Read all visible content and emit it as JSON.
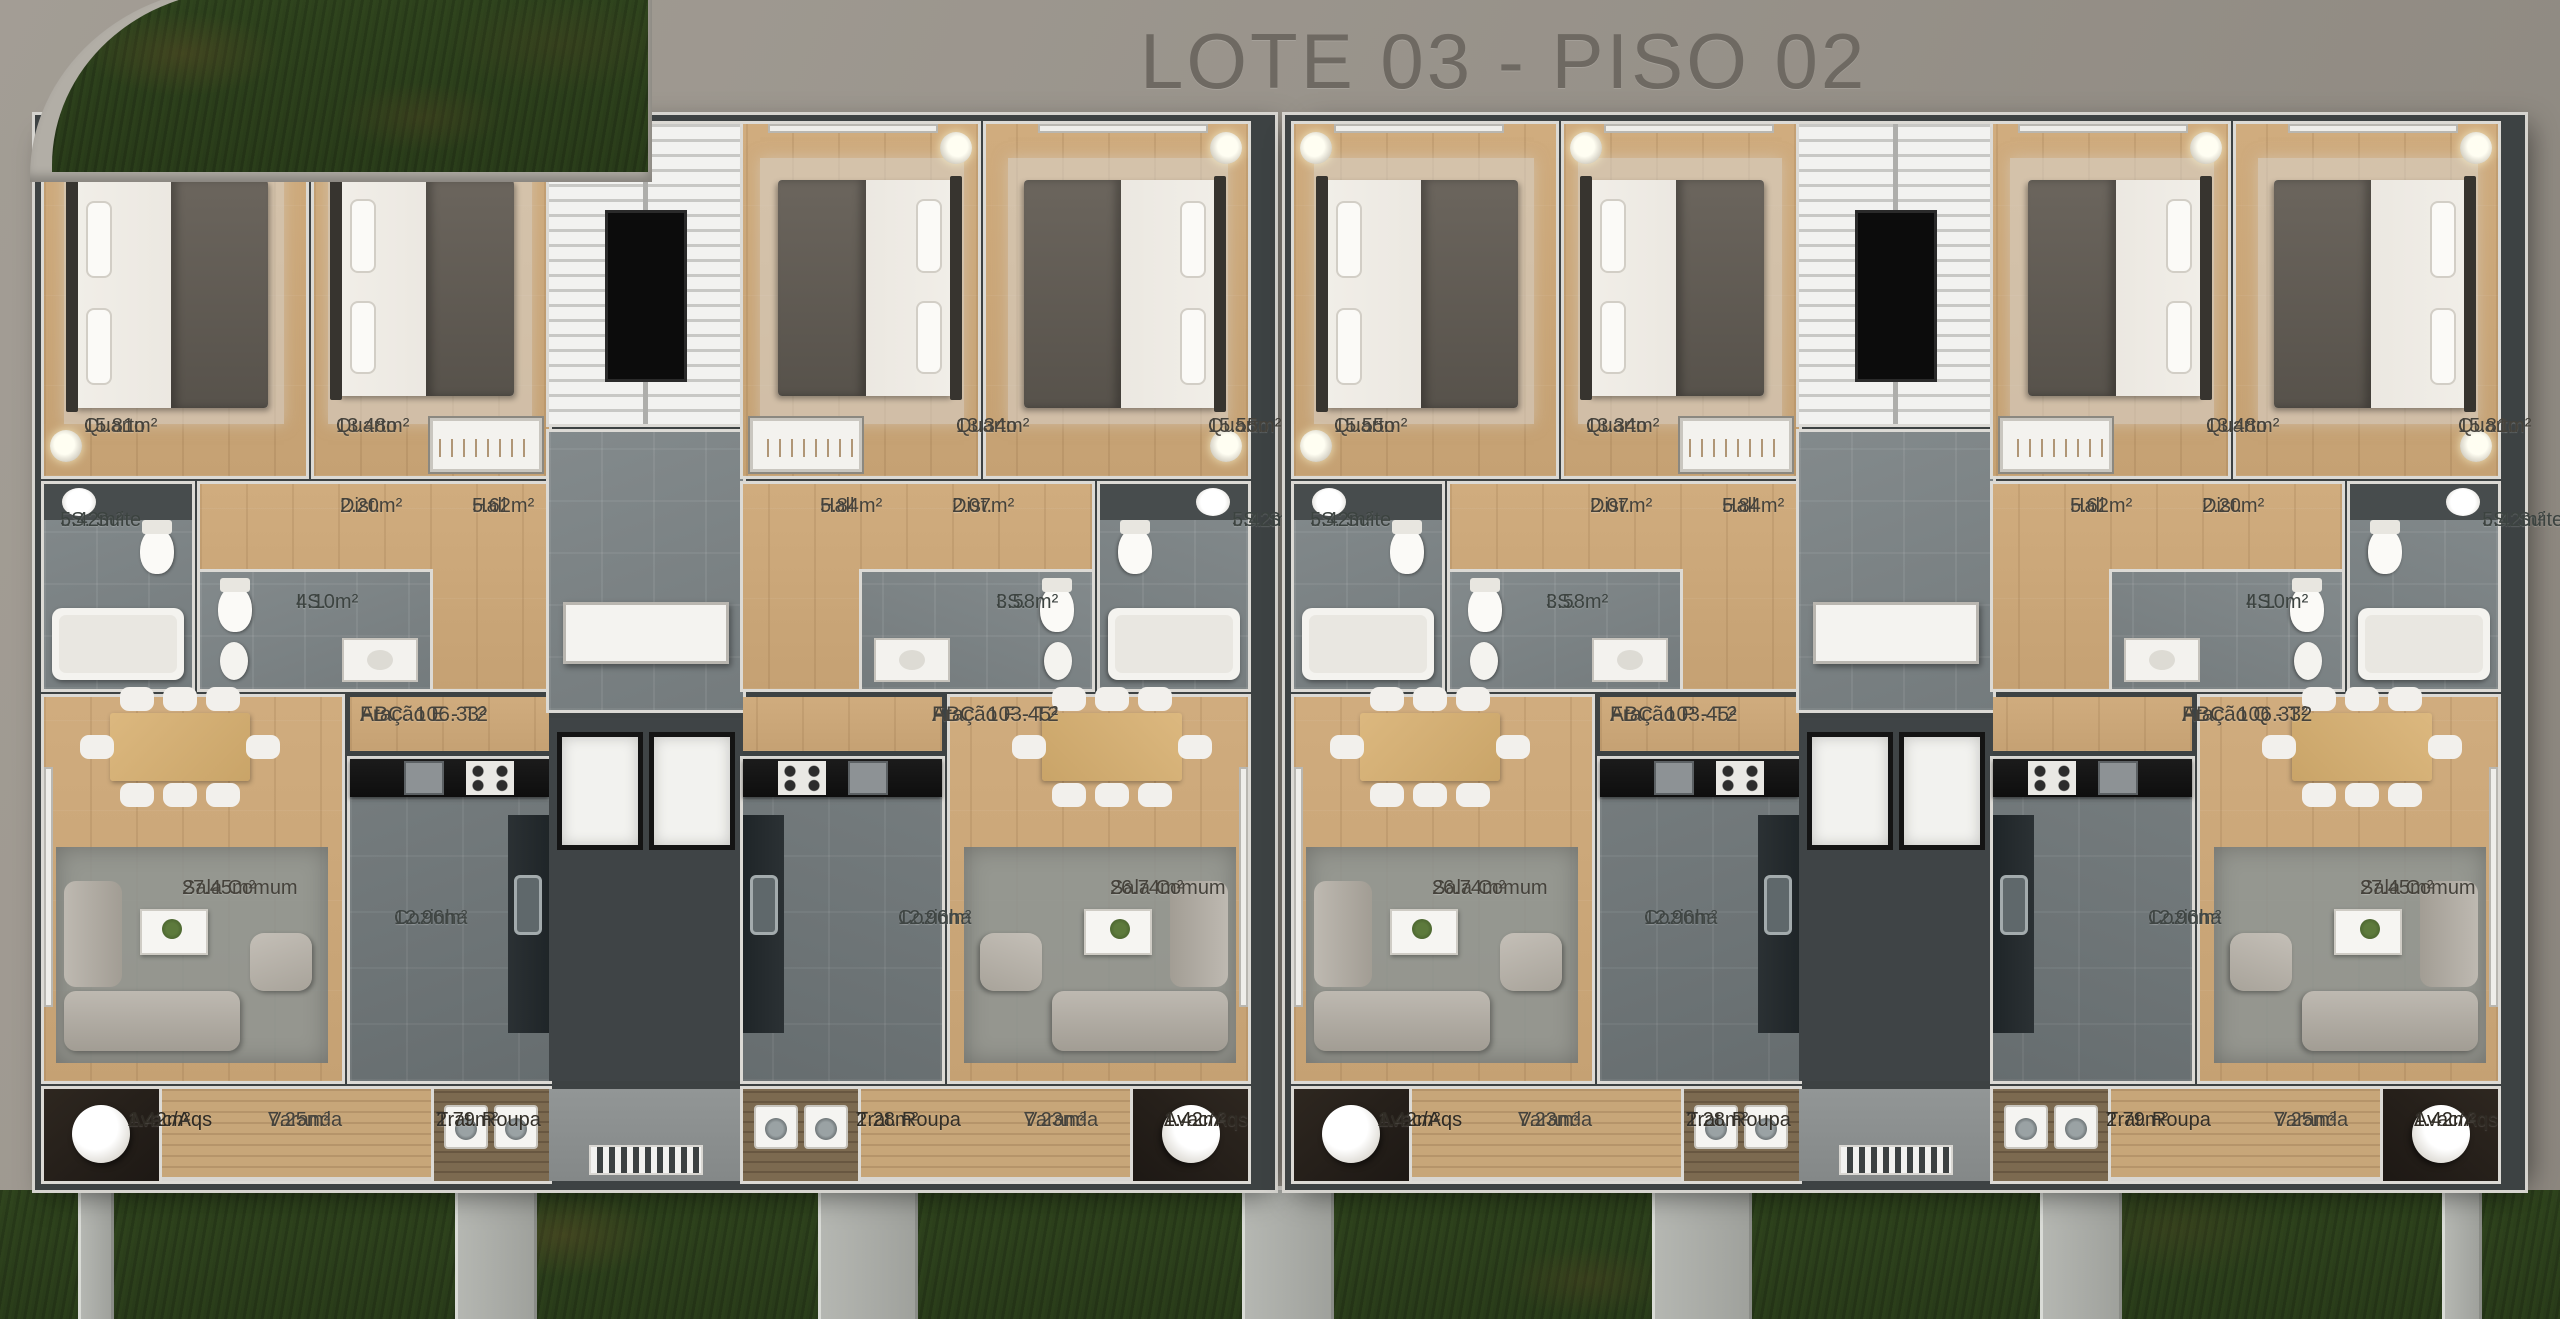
{
  "title": "LOTE 03 - PISO 02",
  "buildings": [
    {
      "id": "building-left",
      "units": [
        {
          "fraction": "Fração E - T2",
          "abc": "ABC: 106.33²",
          "rooms": {
            "quarto_outer": {
              "name": "Quarto",
              "area": "15.81m²"
            },
            "quarto_inner": {
              "name": "Quarto",
              "area": "13.48m²"
            },
            "is_suite": {
              "name": "I.S. Suite",
              "area": "5.42m²"
            },
            "is": {
              "name": "I.S.",
              "area": "4.10m²"
            },
            "dist": {
              "name": "Dist.",
              "area": "2.20m²"
            },
            "hall": {
              "name": "Hall",
              "area": "5.62m²"
            },
            "sala_comum": {
              "name": "Sala Comum",
              "area": "27.45m²"
            },
            "cozinha": {
              "name": "Cozinha",
              "area": "12.96m²"
            },
            "avac_aqs": {
              "name": "Avac/Aqs",
              "area": "1.42m²"
            },
            "varanda": {
              "name": "Varanda",
              "area": "7.25m²"
            },
            "trat_roupa": {
              "name": "Trat. Roupa",
              "area": "2.79m²"
            }
          }
        },
        {
          "fraction": "Fração F - T2",
          "abc": "ABC: 103.45²",
          "rooms": {
            "quarto_outer": {
              "name": "Quarto",
              "area": "15.55m²"
            },
            "quarto_inner": {
              "name": "Quarto",
              "area": "13.34m²"
            },
            "is_suite": {
              "name": "I.S. Suite",
              "area": "5.42m²"
            },
            "is": {
              "name": "I.S.",
              "area": "3.58m²"
            },
            "dist": {
              "name": "Dist.",
              "area": "2.07m²"
            },
            "hall": {
              "name": "Hall",
              "area": "5.84m²"
            },
            "sala_comum": {
              "name": "Sala Comum",
              "area": "26.74m²"
            },
            "cozinha": {
              "name": "Cozinha",
              "area": "12.96m²"
            },
            "avac_aqs": {
              "name": "Avac/Aqs",
              "area": "1.42m²"
            },
            "varanda": {
              "name": "Varanda",
              "area": "7.23m²"
            },
            "trat_roupa": {
              "name": "Trat. Roupa",
              "area": "2.28m²"
            }
          }
        }
      ]
    },
    {
      "id": "building-right",
      "units": [
        {
          "fraction": "Fração P - T2",
          "abc": "ABC: 103.45²",
          "rooms": {
            "quarto_outer": {
              "name": "Quarto",
              "area": "15.55m²"
            },
            "quarto_inner": {
              "name": "Quarto",
              "area": "13.34m²"
            },
            "is_suite": {
              "name": "I.S. Suite",
              "area": "5.42m²"
            },
            "is": {
              "name": "I.S.",
              "area": "3.58m²"
            },
            "dist": {
              "name": "Dist.",
              "area": "2.07m²"
            },
            "hall": {
              "name": "Hall",
              "area": "5.84m²"
            },
            "sala_comum": {
              "name": "Sala Comum",
              "area": "26.74m²"
            },
            "cozinha": {
              "name": "Cozinha",
              "area": "12.96m²"
            },
            "avac_aqs": {
              "name": "Avac/Aqs",
              "area": "1.42m²"
            },
            "varanda": {
              "name": "Varanda",
              "area": "7.23m²"
            },
            "trat_roupa": {
              "name": "Trat. Roupa",
              "area": "2.28m²"
            }
          }
        },
        {
          "fraction": "Fração Q - T2",
          "abc": "ABC: 106.33²",
          "rooms": {
            "quarto_outer": {
              "name": "Quarto",
              "area": "15.81m²"
            },
            "quarto_inner": {
              "name": "Quarto",
              "area": "13.48m²"
            },
            "is_suite": {
              "name": "I.S. Suite",
              "area": "5.42m²"
            },
            "is": {
              "name": "I.S.",
              "area": "4.10m²"
            },
            "dist": {
              "name": "Dist.",
              "area": "2.20m²"
            },
            "hall": {
              "name": "Hall",
              "area": "5.62m²"
            },
            "sala_comum": {
              "name": "Sala Comum",
              "area": "27.45m²"
            },
            "cozinha": {
              "name": "Cozinha",
              "area": "12.96m²"
            },
            "avac_aqs": {
              "name": "Avac/Aqs",
              "area": "1.42m²"
            },
            "varanda": {
              "name": "Varanda",
              "area": "7.25m²"
            },
            "trat_roupa": {
              "name": "Trat. Roupa",
              "area": "2.79m²"
            }
          }
        }
      ]
    }
  ]
}
